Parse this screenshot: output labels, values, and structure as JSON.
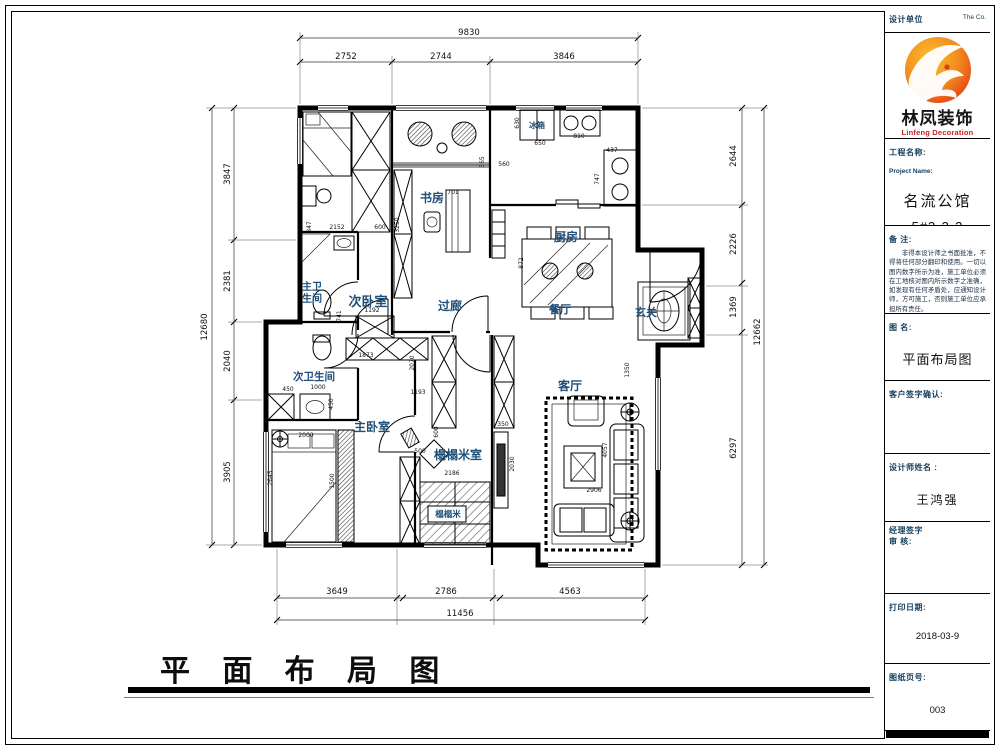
{
  "sheet": {
    "bottom_title": "平 面 布 局 图"
  },
  "titleblock": {
    "header_left": "设计单位",
    "header_right": "The   Co.",
    "logo": {
      "cn": "林凤装饰",
      "en": "Linfeng Decoration"
    },
    "project": {
      "label_cn": "工程名称:",
      "label_en": "Project Name:",
      "name": "名流公馆",
      "number": "5#3-3-2"
    },
    "remarks": {
      "label": "备  注:",
      "text": "非得本设计师之书面批准，不得将任何部分翻印和使用。一切以图内数字所示为准，施工单位必须在工地核对图内所示数字之准确，如发现有任何矛盾处，应通知设计师，方可施工，否则施工单位应承担所有责任。"
    },
    "drawing_name": {
      "label": "图  名:",
      "value": "平面布局图"
    },
    "client_sign_label": "客户签字确认:",
    "designer": {
      "label": "设计师姓名 :",
      "value": "王鸿强"
    },
    "manager": {
      "label_line1": "经理签字",
      "label_line2": "审  核:"
    },
    "print_date": {
      "label": "打印日期:",
      "value": "2018-03-9"
    },
    "sheet_no": {
      "label": "图纸页号:",
      "value": "003"
    }
  },
  "plan": {
    "room_labels": [
      {
        "t": "次卧室",
        "x": 368,
        "y": 306,
        "s": 13,
        "n": "room-label-second-bedroom"
      },
      {
        "t": "书房",
        "x": 432,
        "y": 202,
        "s": 12,
        "n": "room-label-study"
      },
      {
        "t": "厨房",
        "x": 566,
        "y": 241,
        "s": 12,
        "n": "room-label-kitchen"
      },
      {
        "t": "冰箱",
        "x": 537,
        "y": 128,
        "s": 8,
        "n": "label-refrigerator"
      },
      {
        "t": "过廊",
        "x": 450,
        "y": 310,
        "s": 12,
        "n": "room-label-corridor"
      },
      {
        "t": "餐厅",
        "x": 560,
        "y": 313,
        "s": 11,
        "n": "room-label-dining"
      },
      {
        "t": "玄关",
        "x": 646,
        "y": 316,
        "s": 11,
        "n": "room-label-entry"
      },
      {
        "t": "主卫",
        "x": 312,
        "y": 290,
        "s": 10,
        "n": "room-label-master-bath-1"
      },
      {
        "t": "生间",
        "x": 312,
        "y": 302,
        "s": 10,
        "n": "room-label-master-bath-2"
      },
      {
        "t": "次卫生间",
        "x": 314,
        "y": 380,
        "s": 10.5,
        "n": "room-label-second-bath"
      },
      {
        "t": "主卧室",
        "x": 372,
        "y": 431,
        "s": 12,
        "n": "room-label-master-bedroom"
      },
      {
        "t": "榻榻米室",
        "x": 458,
        "y": 459,
        "s": 12,
        "n": "room-label-tatami-room"
      },
      {
        "t": "榻榻米",
        "x": 448,
        "y": 517,
        "s": 8.5,
        "n": "label-tatami-mat"
      },
      {
        "t": "客厅",
        "x": 570,
        "y": 390,
        "s": 12,
        "n": "room-label-living"
      }
    ],
    "dim_labels": [
      {
        "t": "9830",
        "x": 469,
        "y": 35,
        "s": 8.5
      },
      {
        "t": "2752",
        "x": 346,
        "y": 59,
        "s": 8.5
      },
      {
        "t": "2744",
        "x": 441,
        "y": 59,
        "s": 8.5
      },
      {
        "t": "3846",
        "x": 564,
        "y": 59,
        "s": 8.5
      },
      {
        "t": "12680",
        "x": 207,
        "y": 327,
        "s": 8.5,
        "r": -90
      },
      {
        "t": "3847",
        "x": 230,
        "y": 174,
        "s": 8.5,
        "r": -90
      },
      {
        "t": "2381",
        "x": 230,
        "y": 281,
        "s": 8.5,
        "r": -90
      },
      {
        "t": "2040",
        "x": 230,
        "y": 361,
        "s": 8.5,
        "r": -90
      },
      {
        "t": "3905",
        "x": 230,
        "y": 472,
        "s": 8.5,
        "r": -90
      },
      {
        "t": "2644",
        "x": 736,
        "y": 156,
        "s": 8.5,
        "r": -90
      },
      {
        "t": "2226",
        "x": 736,
        "y": 244,
        "s": 8.5,
        "r": -90
      },
      {
        "t": "1369",
        "x": 736,
        "y": 307,
        "s": 8.5,
        "r": -90
      },
      {
        "t": "6297",
        "x": 736,
        "y": 448,
        "s": 8.5,
        "r": -90
      },
      {
        "t": "12662",
        "x": 760,
        "y": 332,
        "s": 8.5,
        "r": -90
      },
      {
        "t": "3649",
        "x": 337,
        "y": 594,
        "s": 8.5
      },
      {
        "t": "2786",
        "x": 446,
        "y": 594,
        "s": 8.5
      },
      {
        "t": "4563",
        "x": 570,
        "y": 594,
        "s": 8.5
      },
      {
        "t": "11456",
        "x": 460,
        "y": 616,
        "s": 8.5
      },
      {
        "t": "2152",
        "x": 337,
        "y": 229,
        "s": 6
      },
      {
        "t": "600",
        "x": 380,
        "y": 229,
        "s": 6
      },
      {
        "t": "847",
        "x": 311,
        "y": 227,
        "s": 6,
        "r": -90
      },
      {
        "t": "3250",
        "x": 399,
        "y": 225,
        "s": 6,
        "r": -90
      },
      {
        "t": "701",
        "x": 453,
        "y": 194,
        "s": 6
      },
      {
        "t": "565",
        "x": 484,
        "y": 162,
        "s": 6,
        "r": -90
      },
      {
        "t": "630",
        "x": 519,
        "y": 123,
        "s": 6,
        "r": -90
      },
      {
        "t": "650",
        "x": 540,
        "y": 145,
        "s": 6
      },
      {
        "t": "810",
        "x": 579,
        "y": 138,
        "s": 6
      },
      {
        "t": "437",
        "x": 612,
        "y": 152,
        "s": 6
      },
      {
        "t": "747",
        "x": 599,
        "y": 179,
        "s": 6,
        "r": -90
      },
      {
        "t": "560",
        "x": 504,
        "y": 166,
        "s": 6
      },
      {
        "t": "2126",
        "x": 566,
        "y": 241,
        "s": 6
      },
      {
        "t": "872",
        "x": 523,
        "y": 263,
        "s": 6,
        "r": -90
      },
      {
        "t": "1192",
        "x": 372,
        "y": 312,
        "s": 6
      },
      {
        "t": "741",
        "x": 341,
        "y": 316,
        "s": 6,
        "r": -90
      },
      {
        "t": "1873",
        "x": 366,
        "y": 357,
        "s": 6
      },
      {
        "t": "2070",
        "x": 414,
        "y": 363,
        "s": 6,
        "r": -90
      },
      {
        "t": "1193",
        "x": 418,
        "y": 394,
        "s": 6
      },
      {
        "t": "450",
        "x": 288,
        "y": 391,
        "s": 6
      },
      {
        "t": "1000",
        "x": 318,
        "y": 389,
        "s": 6
      },
      {
        "t": "450",
        "x": 333,
        "y": 404,
        "s": 6,
        "r": -90
      },
      {
        "t": "2000",
        "x": 306,
        "y": 437,
        "s": 6
      },
      {
        "t": "2645",
        "x": 272,
        "y": 478,
        "s": 6,
        "r": -90
      },
      {
        "t": "1500",
        "x": 334,
        "y": 481,
        "s": 6,
        "r": -90
      },
      {
        "t": "600",
        "x": 438,
        "y": 432,
        "s": 6,
        "r": -90
      },
      {
        "t": "500",
        "x": 420,
        "y": 453,
        "s": 6
      },
      {
        "t": "2186",
        "x": 452,
        "y": 475,
        "s": 6
      },
      {
        "t": "350",
        "x": 503,
        "y": 426,
        "s": 6
      },
      {
        "t": "2030",
        "x": 514,
        "y": 464,
        "s": 6,
        "r": -90
      },
      {
        "t": "2906",
        "x": 594,
        "y": 492,
        "s": 6
      },
      {
        "t": "4057",
        "x": 607,
        "y": 450,
        "s": 6,
        "r": -90
      },
      {
        "t": "1350",
        "x": 629,
        "y": 370,
        "s": 6,
        "r": -90
      }
    ]
  }
}
